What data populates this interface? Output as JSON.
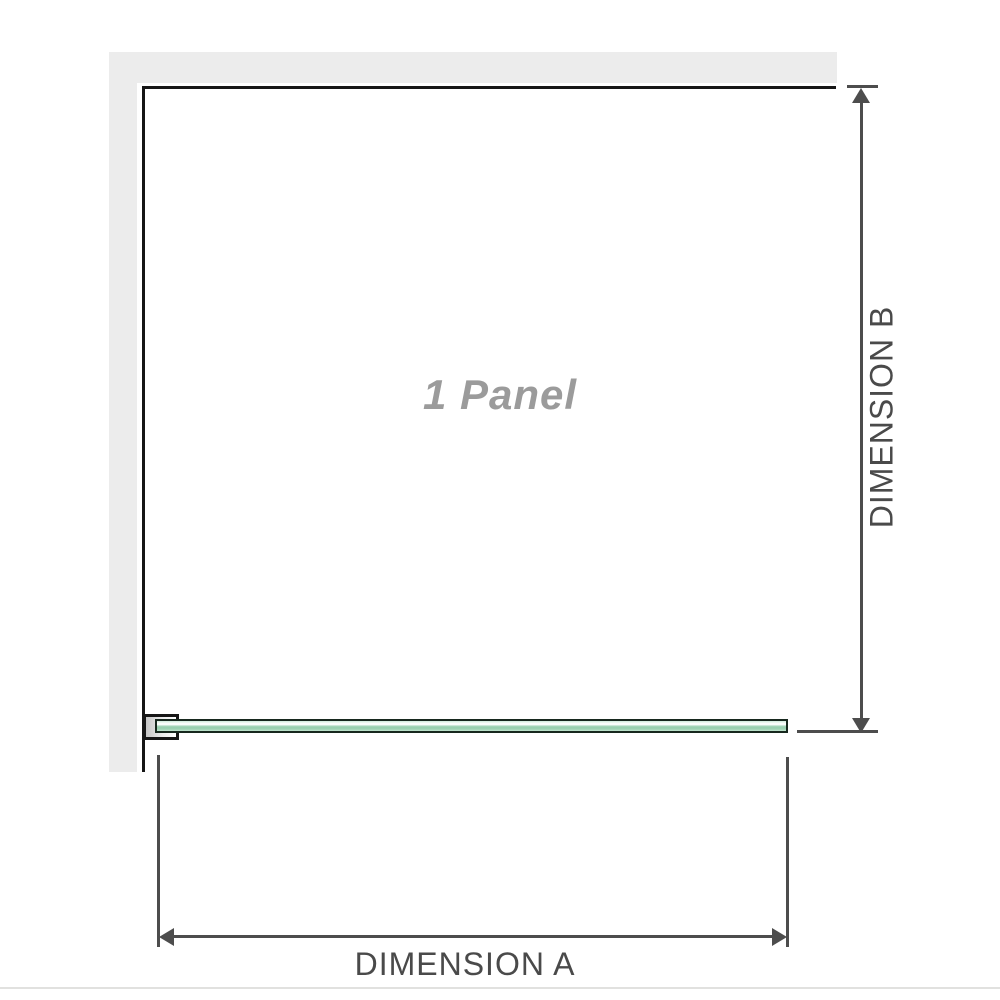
{
  "diagram": {
    "panel_label": "1 Panel",
    "dimension_a": {
      "label": "DIMENSION A"
    },
    "dimension_b": {
      "label": "DIMENSION B"
    }
  },
  "colors": {
    "wall": "#ececec",
    "outline": "#161616",
    "dim": "#4d4d4d",
    "dim-label": "#4a4a4a",
    "panel-label": "#9b9b9b",
    "glass-green": "#9fd3b5",
    "divider": "#e1e1df"
  }
}
